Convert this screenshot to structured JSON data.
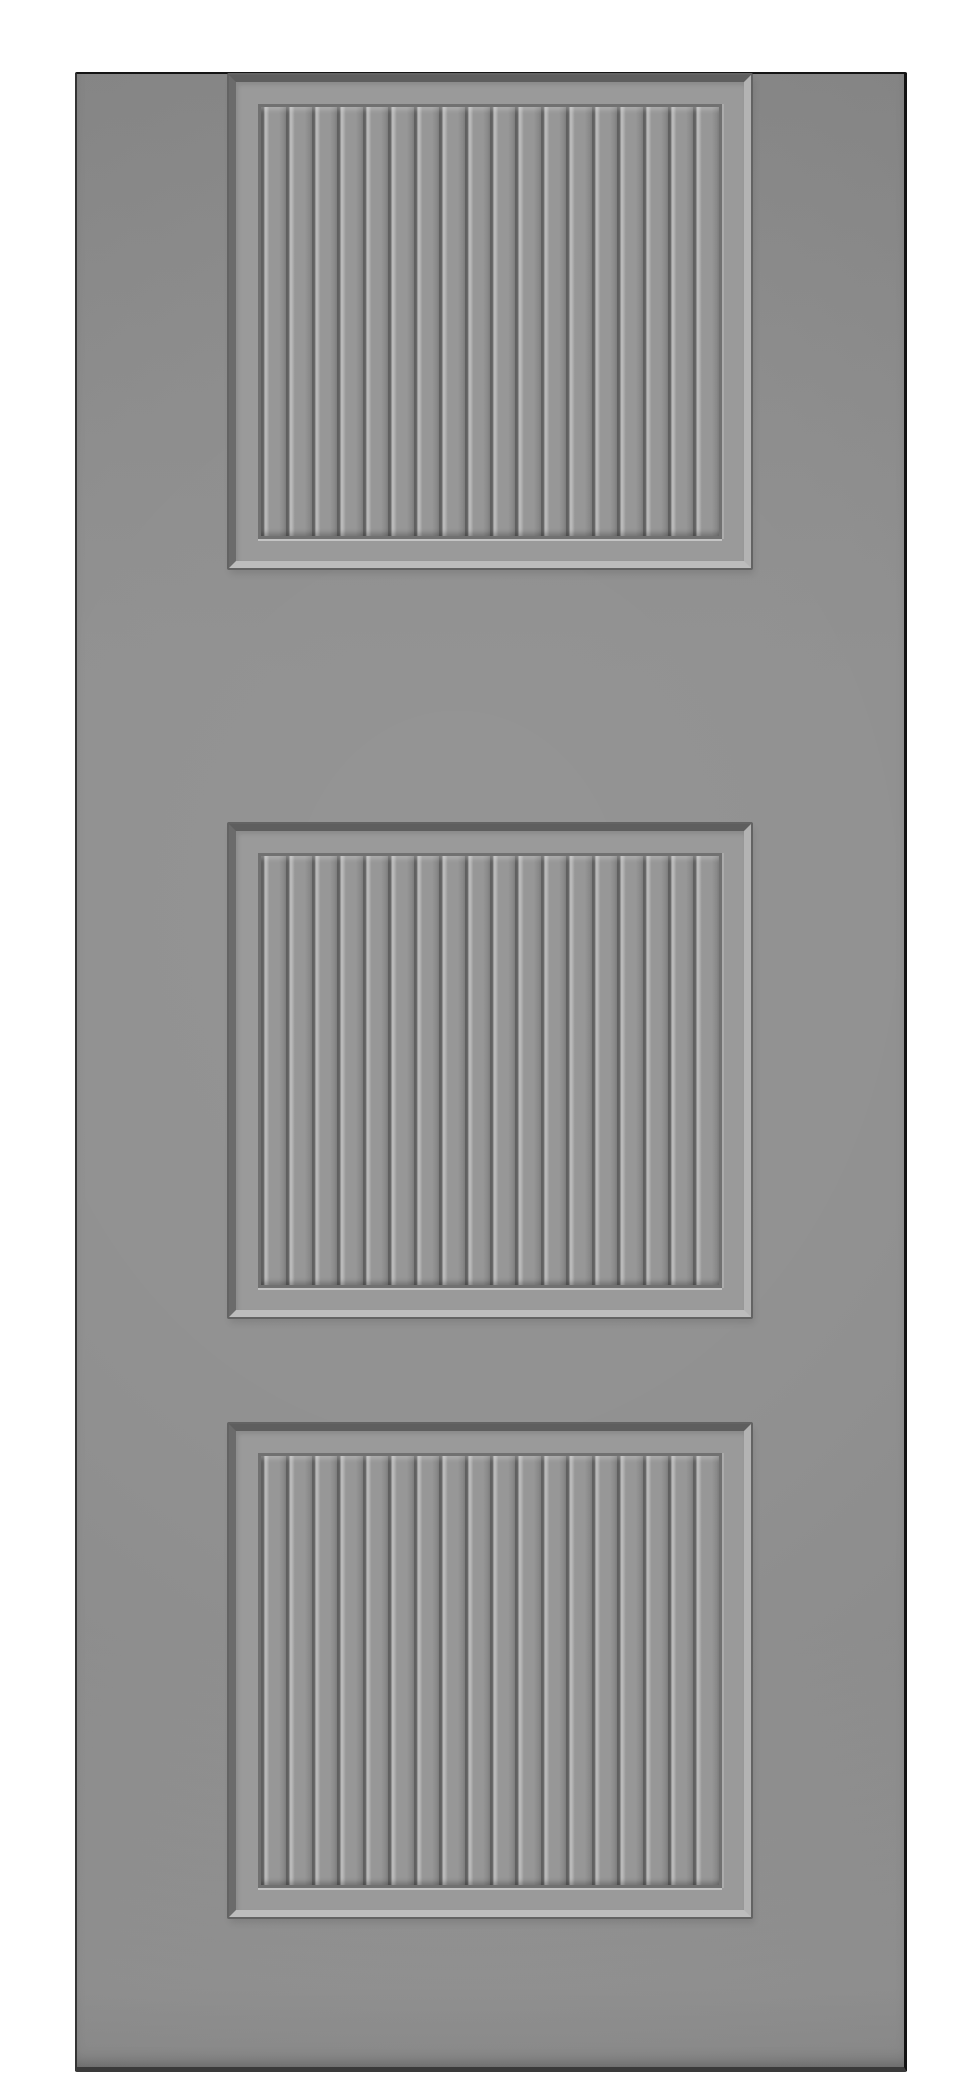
{
  "meta": {
    "description": "Product photo of a gray interior slab door with three recessed square beadboard panels, centered on a plain white background"
  },
  "canvas": {
    "background_color": "#ffffff"
  },
  "door": {
    "label": "three-panel-beadboard-door",
    "panel_count": 3,
    "slats_per_panel": 18,
    "colors": {
      "background": "#ffffff",
      "face_top": "#888888",
      "face_mid": "#8f8f8f",
      "face_low": "#959595",
      "edge_top": "#141414",
      "edge_left": "#343434",
      "edge_right": "#121212",
      "edge_bottom": "#3a3a3a",
      "frame": "#9a9a9a",
      "bevel_top": "#5e5e5e",
      "bevel_left": "#6b6b6b",
      "bevel_bottom": "#bdbdbd",
      "bevel_right": "#b3b3b3",
      "outer_line": "#636363",
      "step_dark": "#717171",
      "step_highlight": "#c4c4c4",
      "groove_dark": "#616161",
      "groove_soft": "#7d7d7d",
      "bead_highlight": "#b9b9b9",
      "slat_face": "#979797",
      "slat_shade": "#8a8a8a"
    }
  }
}
